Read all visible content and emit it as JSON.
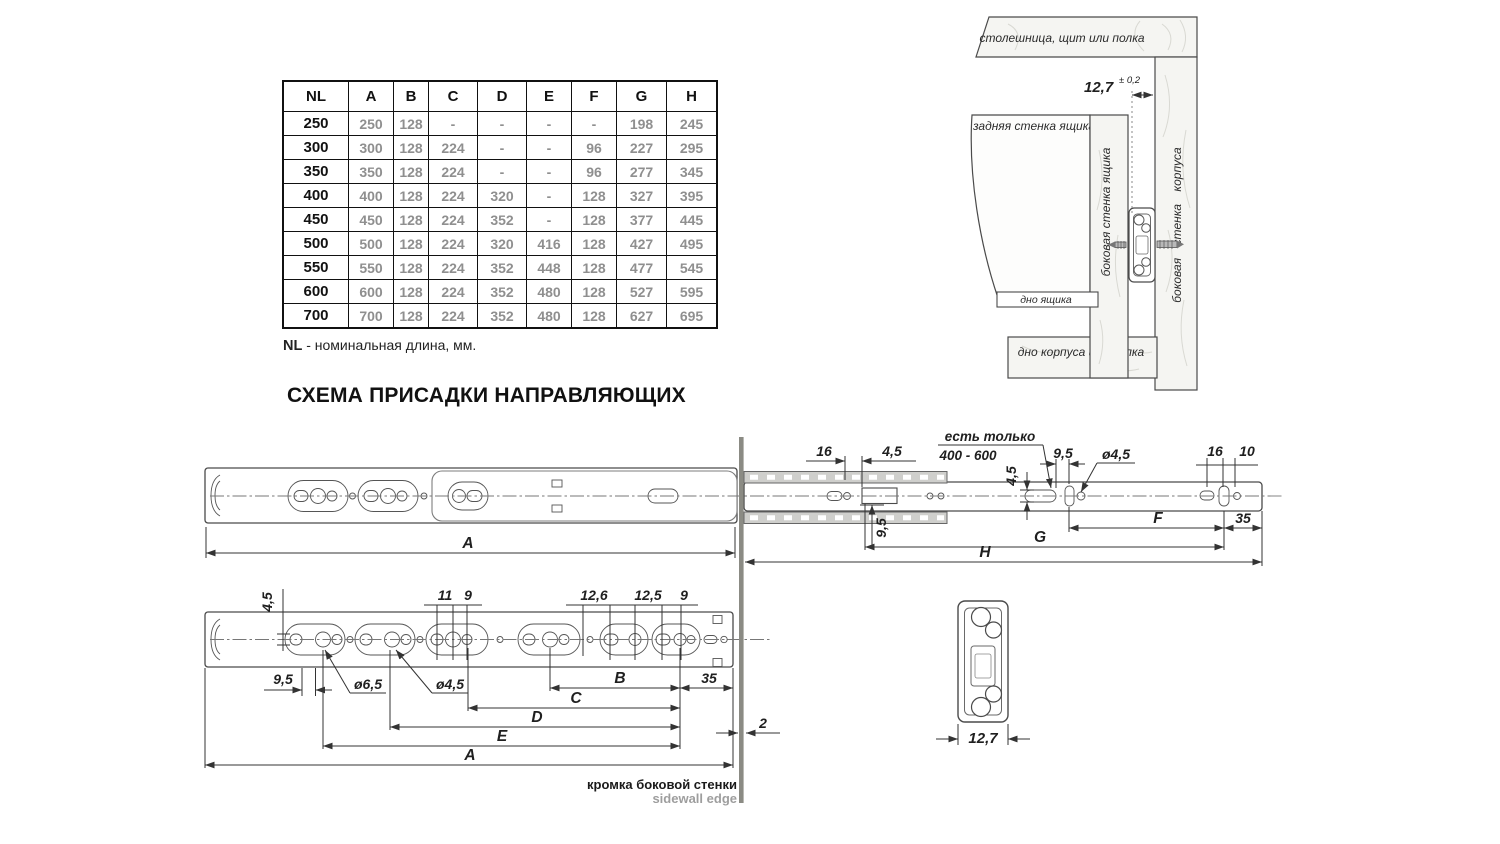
{
  "table": {
    "columns": [
      "NL",
      "A",
      "B",
      "C",
      "D",
      "E",
      "F",
      "G",
      "H"
    ],
    "rows": [
      [
        "250",
        "250",
        "128",
        "-",
        "-",
        "-",
        "-",
        "198",
        "245"
      ],
      [
        "300",
        "300",
        "128",
        "224",
        "-",
        "-",
        "96",
        "227",
        "295"
      ],
      [
        "350",
        "350",
        "128",
        "224",
        "-",
        "-",
        "96",
        "277",
        "345"
      ],
      [
        "400",
        "400",
        "128",
        "224",
        "320",
        "-",
        "128",
        "327",
        "395"
      ],
      [
        "450",
        "450",
        "128",
        "224",
        "352",
        "-",
        "128",
        "377",
        "445"
      ],
      [
        "500",
        "500",
        "128",
        "224",
        "320",
        "416",
        "128",
        "427",
        "495"
      ],
      [
        "550",
        "550",
        "128",
        "224",
        "352",
        "448",
        "128",
        "477",
        "545"
      ],
      [
        "600",
        "600",
        "128",
        "224",
        "352",
        "480",
        "128",
        "527",
        "595"
      ],
      [
        "700",
        "700",
        "128",
        "224",
        "352",
        "480",
        "128",
        "627",
        "695"
      ]
    ],
    "caption_bold": "NL",
    "caption_rest": " - номинальная длина, мм."
  },
  "title": "СХЕМА ПРИСАДКИ НАПРАВЛЯЮЩИХ",
  "install": {
    "top_panel": "столешница, щит или полка",
    "back_panel": "задняя стенка ящика",
    "drawer_side": "боковая стенка ящика",
    "cabinet_side": "боковая стенка корпуса",
    "drawer_bottom": "дно ящика",
    "cabinet_bottom": "дно корпуса или полка",
    "gap_dim": "12,7",
    "gap_tol": "± 0,2"
  },
  "top_view": {
    "dim_16_left": "16",
    "dim_45_left": "4,5",
    "dim_95_vert": "9,5",
    "note_line1": "есть только",
    "note_line2": "400 - 600",
    "dim_45_slot": "4,5",
    "dim_95_slot": "9,5",
    "dia_45": "ø4,5",
    "dim_16_right": "16",
    "dim_10": "10",
    "dim_F": "F",
    "dim_35": "35",
    "dim_G": "G",
    "dim_H": "H",
    "dim_A": "A"
  },
  "front_view": {
    "dim_45_vert": "4,5",
    "dim_95": "9,5",
    "dia_65": "ø6,5",
    "dia_45": "ø4,5",
    "dim_11": "11",
    "dim_9a": "9",
    "dim_126": "12,6",
    "dim_125": "12,5",
    "dim_9b": "9",
    "dim_B": "B",
    "dim_35": "35",
    "dim_C": "C",
    "dim_D": "D",
    "dim_E": "E",
    "dim_A": "A",
    "dim_2": "2",
    "edge_label_ru": "кромка боковой стенки",
    "edge_label_en": "sidewall edge"
  },
  "cross_section": {
    "dim_127": "12,7"
  }
}
